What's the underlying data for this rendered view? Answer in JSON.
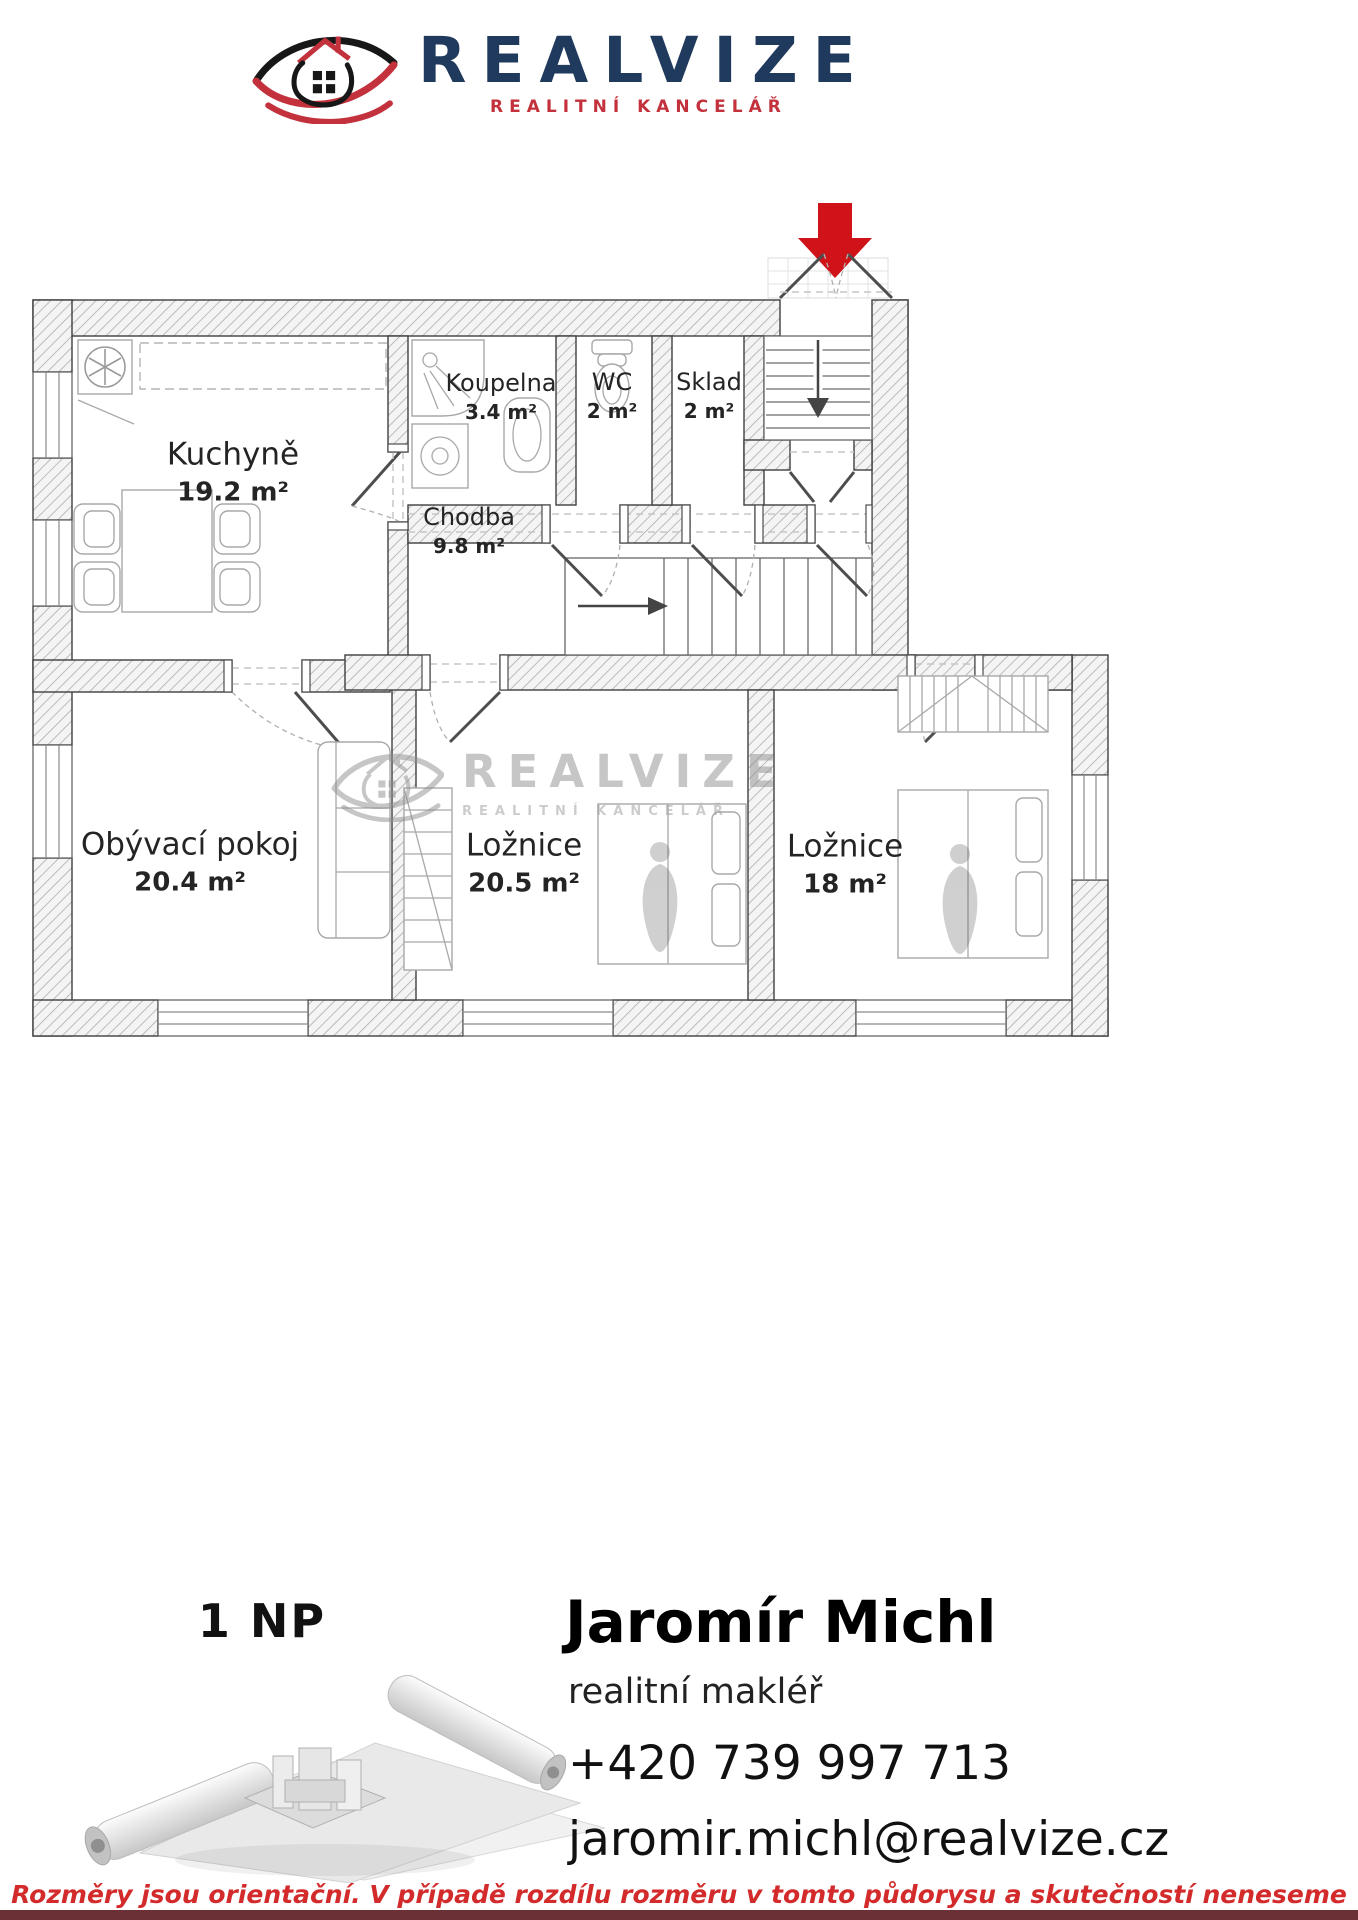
{
  "header": {
    "brand": "REALVIZE",
    "subtitle": "REALITNÍ KANCELÁŘ"
  },
  "watermark": {
    "brand": "REALVIZE",
    "subtitle": "REALITNÍ KANCELÁŘ"
  },
  "floorplan": {
    "rooms": [
      {
        "id": "kuchyne",
        "name": "Kuchyně",
        "area": "19.2 m²",
        "cx": 233,
        "cy": 473,
        "size": "lg"
      },
      {
        "id": "koupelna",
        "name": "Koupelna",
        "area": "3.4 m²",
        "cx": 501,
        "cy": 397,
        "size": "sm"
      },
      {
        "id": "wc",
        "name": "WC",
        "area": "2 m²",
        "cx": 612,
        "cy": 396,
        "size": "sm"
      },
      {
        "id": "sklad",
        "name": "Sklad",
        "area": "2 m²",
        "cx": 709,
        "cy": 396,
        "size": "sm"
      },
      {
        "id": "chodba",
        "name": "Chodba",
        "area": "9.8 m²",
        "cx": 469,
        "cy": 531,
        "size": "sm"
      },
      {
        "id": "obyvaci-pokoj",
        "name": "Obývací pokoj",
        "area": "20.4 m²",
        "cx": 190,
        "cy": 863,
        "size": "lg"
      },
      {
        "id": "loznice-1",
        "name": "Ložnice",
        "area": "20.5 m²",
        "cx": 524,
        "cy": 864,
        "size": "lg"
      },
      {
        "id": "loznice-2",
        "name": "Ložnice",
        "area": "18 m²",
        "cx": 845,
        "cy": 865,
        "size": "lg"
      }
    ]
  },
  "floor_label": "1 NP",
  "agent": {
    "name": "Jaromír Michl",
    "role": "realitní makléř",
    "phone": "+420 739 997 713",
    "email": "jaromir.michl@realvize.cz"
  },
  "disclaimer": "Rozměry jsou orientační. V případě rozdílu rozměru v tomto půdorysu a skutečností neneseme zodpovědnost",
  "colors": {
    "brand_navy": "#1f3a5c",
    "brand_red": "#c3323c",
    "arrow_red": "#cf1318",
    "disclaimer_red": "#d32b2b",
    "bottom_bar": "#6b3036"
  }
}
